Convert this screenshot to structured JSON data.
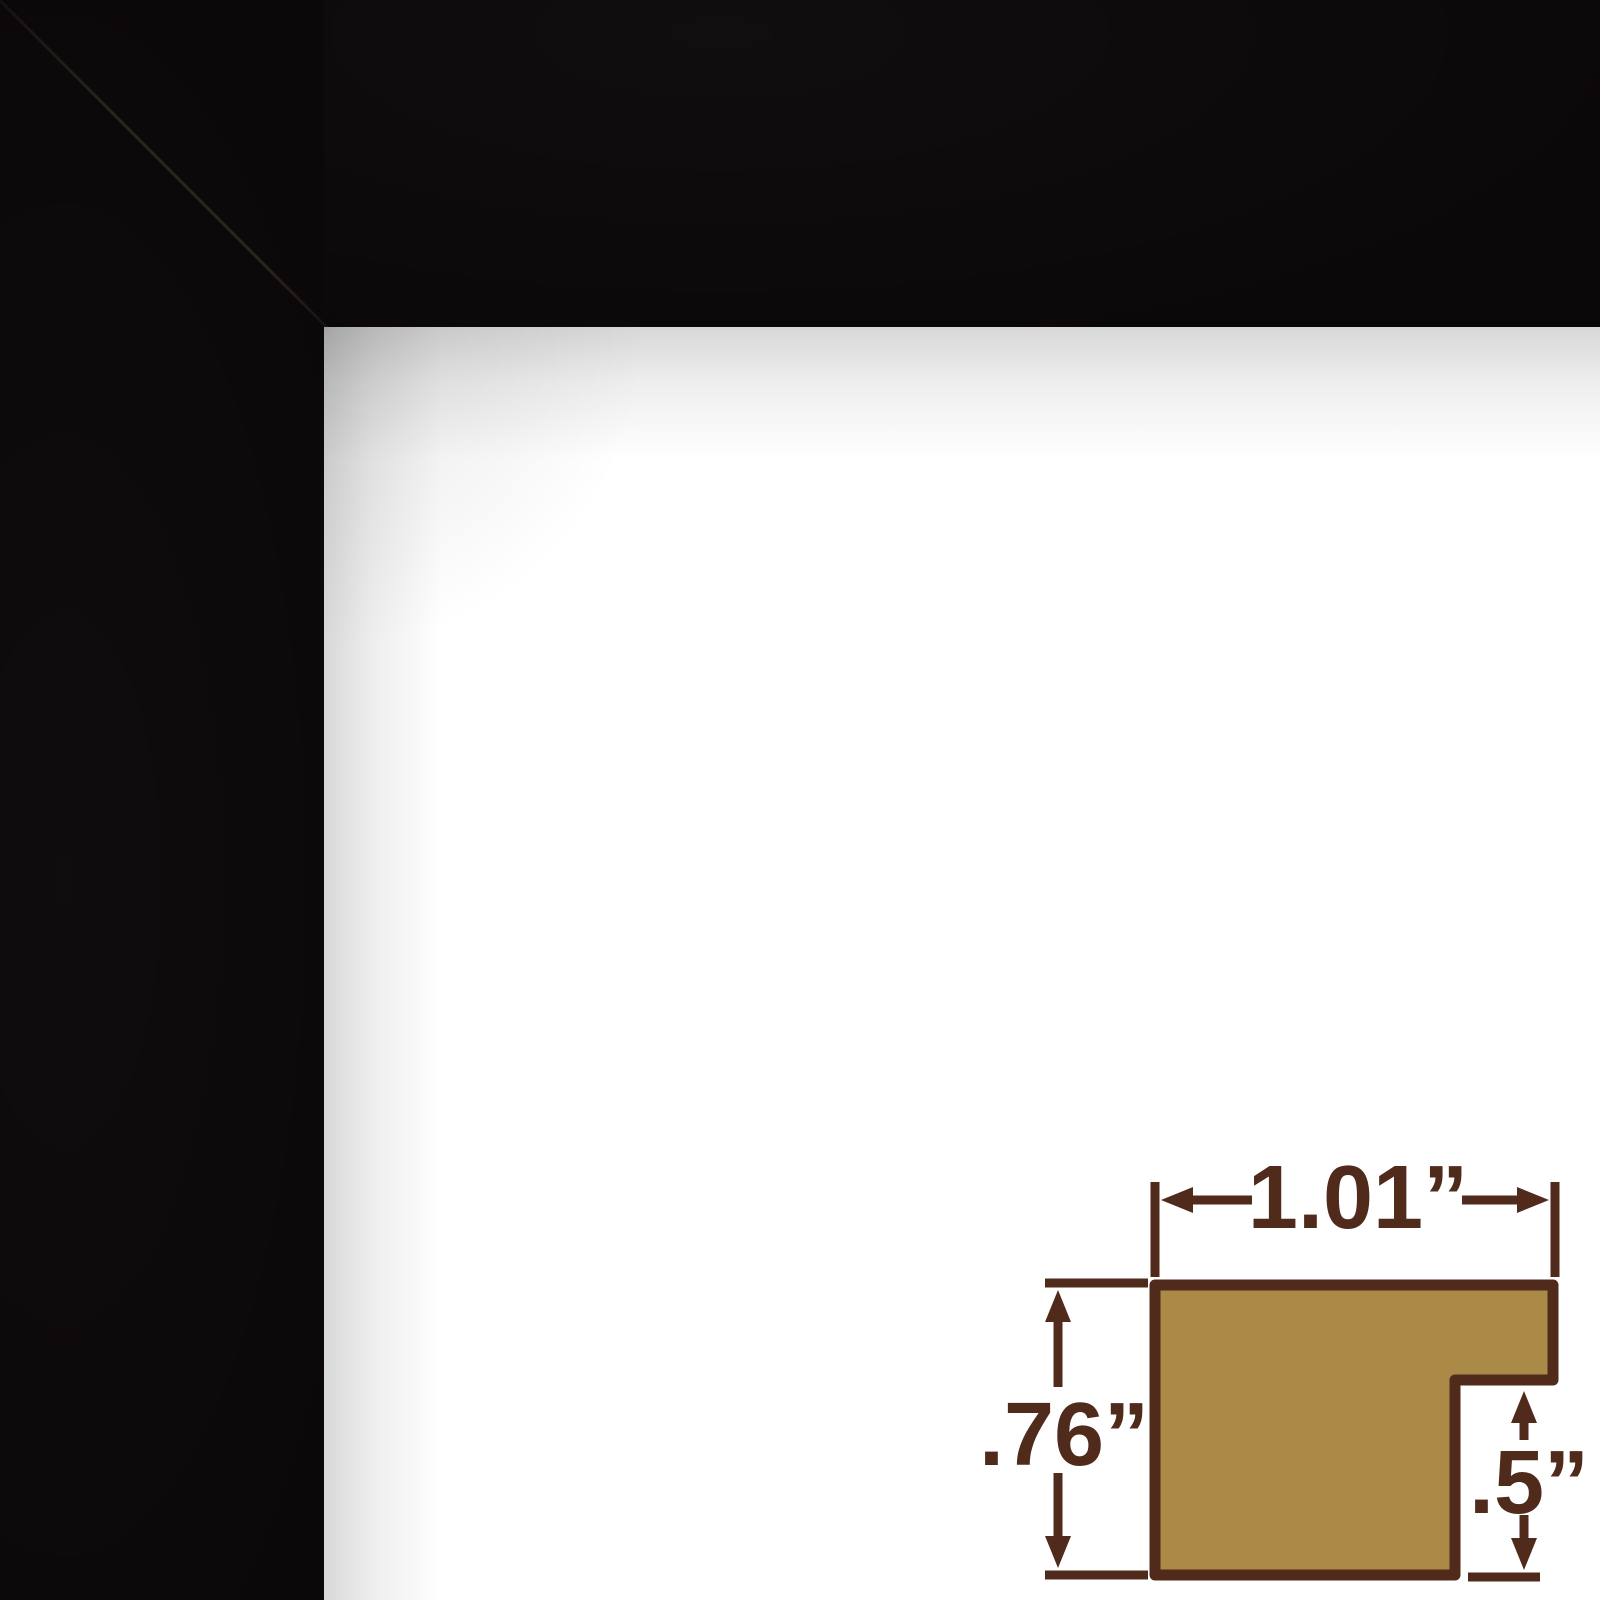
{
  "image_type": "picture-frame-corner-product-photo",
  "colors": {
    "frame-black": "#0b0809",
    "diagram-line": "#502b1c",
    "diagram-fill": "#ab8a47",
    "background": "#ffffff"
  },
  "diagram": {
    "width_label": "1.01”",
    "height_label": ".76”",
    "rabbet_label": ".5”"
  }
}
